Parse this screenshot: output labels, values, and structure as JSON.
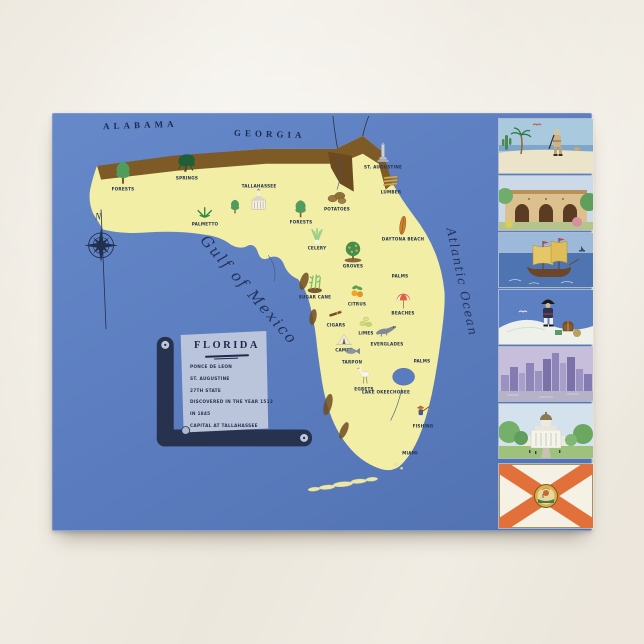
{
  "postcard": {
    "region_labels": {
      "alabama": "ALABAMA",
      "georgia": "GEORGIA"
    },
    "water_labels": {
      "gulf": "Gulf of Mexico",
      "atlantic": "Atlantic Ocean"
    },
    "compass": {
      "north_label": "N"
    },
    "legend_scroll": {
      "title": "FLORIDA",
      "lines": [
        "PONCE DE LEON",
        "ST. AUGUSTINE",
        "27TH STATE",
        "DISCOVERED IN THE YEAR 1513",
        "IN 1845",
        "CAPITAL AT TALLAHASSEE"
      ]
    },
    "map_icons": [
      {
        "type": "tree",
        "label": "FORESTS",
        "x": 70,
        "y": 62,
        "s": 26
      },
      {
        "type": "weep",
        "label": "SPRINGS",
        "x": 134,
        "y": 52,
        "s": 24
      },
      {
        "type": "palmetto",
        "label": "PALMETTO",
        "x": 152,
        "y": 100,
        "s": 20
      },
      {
        "type": "church",
        "label": "TALLAHASSEE",
        "x": 206,
        "y": 84,
        "s": 24,
        "labelTop": true
      },
      {
        "type": "tree",
        "label": "",
        "x": 182,
        "y": 93,
        "s": 16
      },
      {
        "type": "potatoes",
        "label": "POTATOES",
        "x": 284,
        "y": 84,
        "s": 22
      },
      {
        "type": "lumber",
        "label": "LUMBER",
        "x": 338,
        "y": 68,
        "s": 20
      },
      {
        "type": "monument",
        "label": "ST. AUGUSTINE",
        "x": 330,
        "y": 42,
        "s": 22
      },
      {
        "type": "tree",
        "label": "FORESTS",
        "x": 248,
        "y": 98,
        "s": 20
      },
      {
        "type": "celery",
        "label": "CELERY",
        "x": 264,
        "y": 124,
        "s": 20
      },
      {
        "type": "surfboard",
        "label": "DAYTONA BEACH",
        "x": 350,
        "y": 114,
        "s": 22
      },
      {
        "type": "grove",
        "label": "GROVES",
        "x": 300,
        "y": 140,
        "s": 24
      },
      {
        "type": "cane",
        "label": "SUGAR CANE",
        "x": 262,
        "y": 172,
        "s": 22
      },
      {
        "type": "oranges",
        "label": "CITRUS",
        "x": 304,
        "y": 180,
        "s": 20
      },
      {
        "type": "palm",
        "label": "PALMS",
        "x": 347,
        "y": 152,
        "s": 20
      },
      {
        "type": "cigar",
        "label": "CIGARS",
        "x": 283,
        "y": 202,
        "s": 18
      },
      {
        "type": "limes",
        "label": "LIMES",
        "x": 313,
        "y": 210,
        "s": 18
      },
      {
        "type": "umbrella",
        "label": "BEACHES",
        "x": 350,
        "y": 190,
        "s": 18
      },
      {
        "type": "tent",
        "label": "CAMPS",
        "x": 291,
        "y": 227,
        "s": 18
      },
      {
        "type": "gator",
        "label": "EVERGLADES",
        "x": 334,
        "y": 218,
        "s": 24
      },
      {
        "type": "tarpon",
        "label": "TARPON",
        "x": 299,
        "y": 239,
        "s": 18
      },
      {
        "type": "bird",
        "label": "EGRETS",
        "x": 311,
        "y": 264,
        "s": 22
      },
      {
        "type": "palm",
        "label": "PALMS",
        "x": 369,
        "y": 238,
        "s": 18
      },
      {
        "type": "fisher",
        "label": "FISHING",
        "x": 370,
        "y": 302,
        "s": 20
      },
      {
        "type": "palm",
        "label": "MIAMI",
        "x": 357,
        "y": 330,
        "s": 18
      },
      {
        "type": "label",
        "label": "LAKE OKEECHOBEE",
        "x": 333,
        "y": 278,
        "s": 0
      }
    ],
    "vignettes": [
      {
        "name": "explorer-beach",
        "title": "Spanish explorer on the beach"
      },
      {
        "name": "mission-arches",
        "title": "Old Spanish mission arches"
      },
      {
        "name": "galleon",
        "title": "Spanish galleon at sea"
      },
      {
        "name": "pirate-treasure",
        "title": "Pirate with treasure on the dunes"
      },
      {
        "name": "miami-skyline",
        "title": "Miami skyline"
      },
      {
        "name": "state-capitol",
        "title": "State capitol at Tallahassee"
      },
      {
        "name": "state-flag",
        "title": "Florida state flag"
      }
    ],
    "colors": {
      "sea": "#5a7cbe",
      "land": "#f2eea6",
      "border_brown": "#7d5a26",
      "ink": "#22304f",
      "parchment": "#bdc7dd",
      "flag_cross": "#e2703a",
      "flag_seal": "#d8b048"
    }
  }
}
